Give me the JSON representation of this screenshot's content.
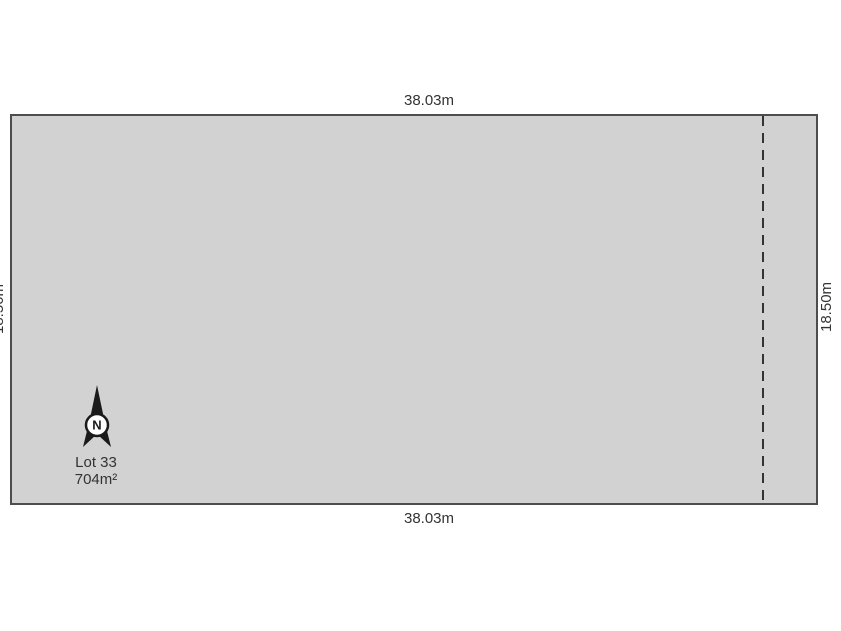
{
  "diagram": {
    "type": "land-lot-plan",
    "lot": {
      "name": "Lot 33",
      "area": "704m²"
    },
    "dimensions": {
      "top": "38.03m",
      "bottom": "38.03m",
      "right": "18.50m",
      "left": "18.50m"
    },
    "compass": {
      "label": "N"
    },
    "features": {
      "dashed_boundary_line": "vertical dashed line near right boundary, full height of lot"
    },
    "colors": {
      "background": "#ffffff",
      "lot_fill": "#d2d2d2",
      "lot_border": "#4d4d4d",
      "dashed_line": "#333333",
      "text": "#333333",
      "compass_fill": "#1a1a1a"
    }
  }
}
